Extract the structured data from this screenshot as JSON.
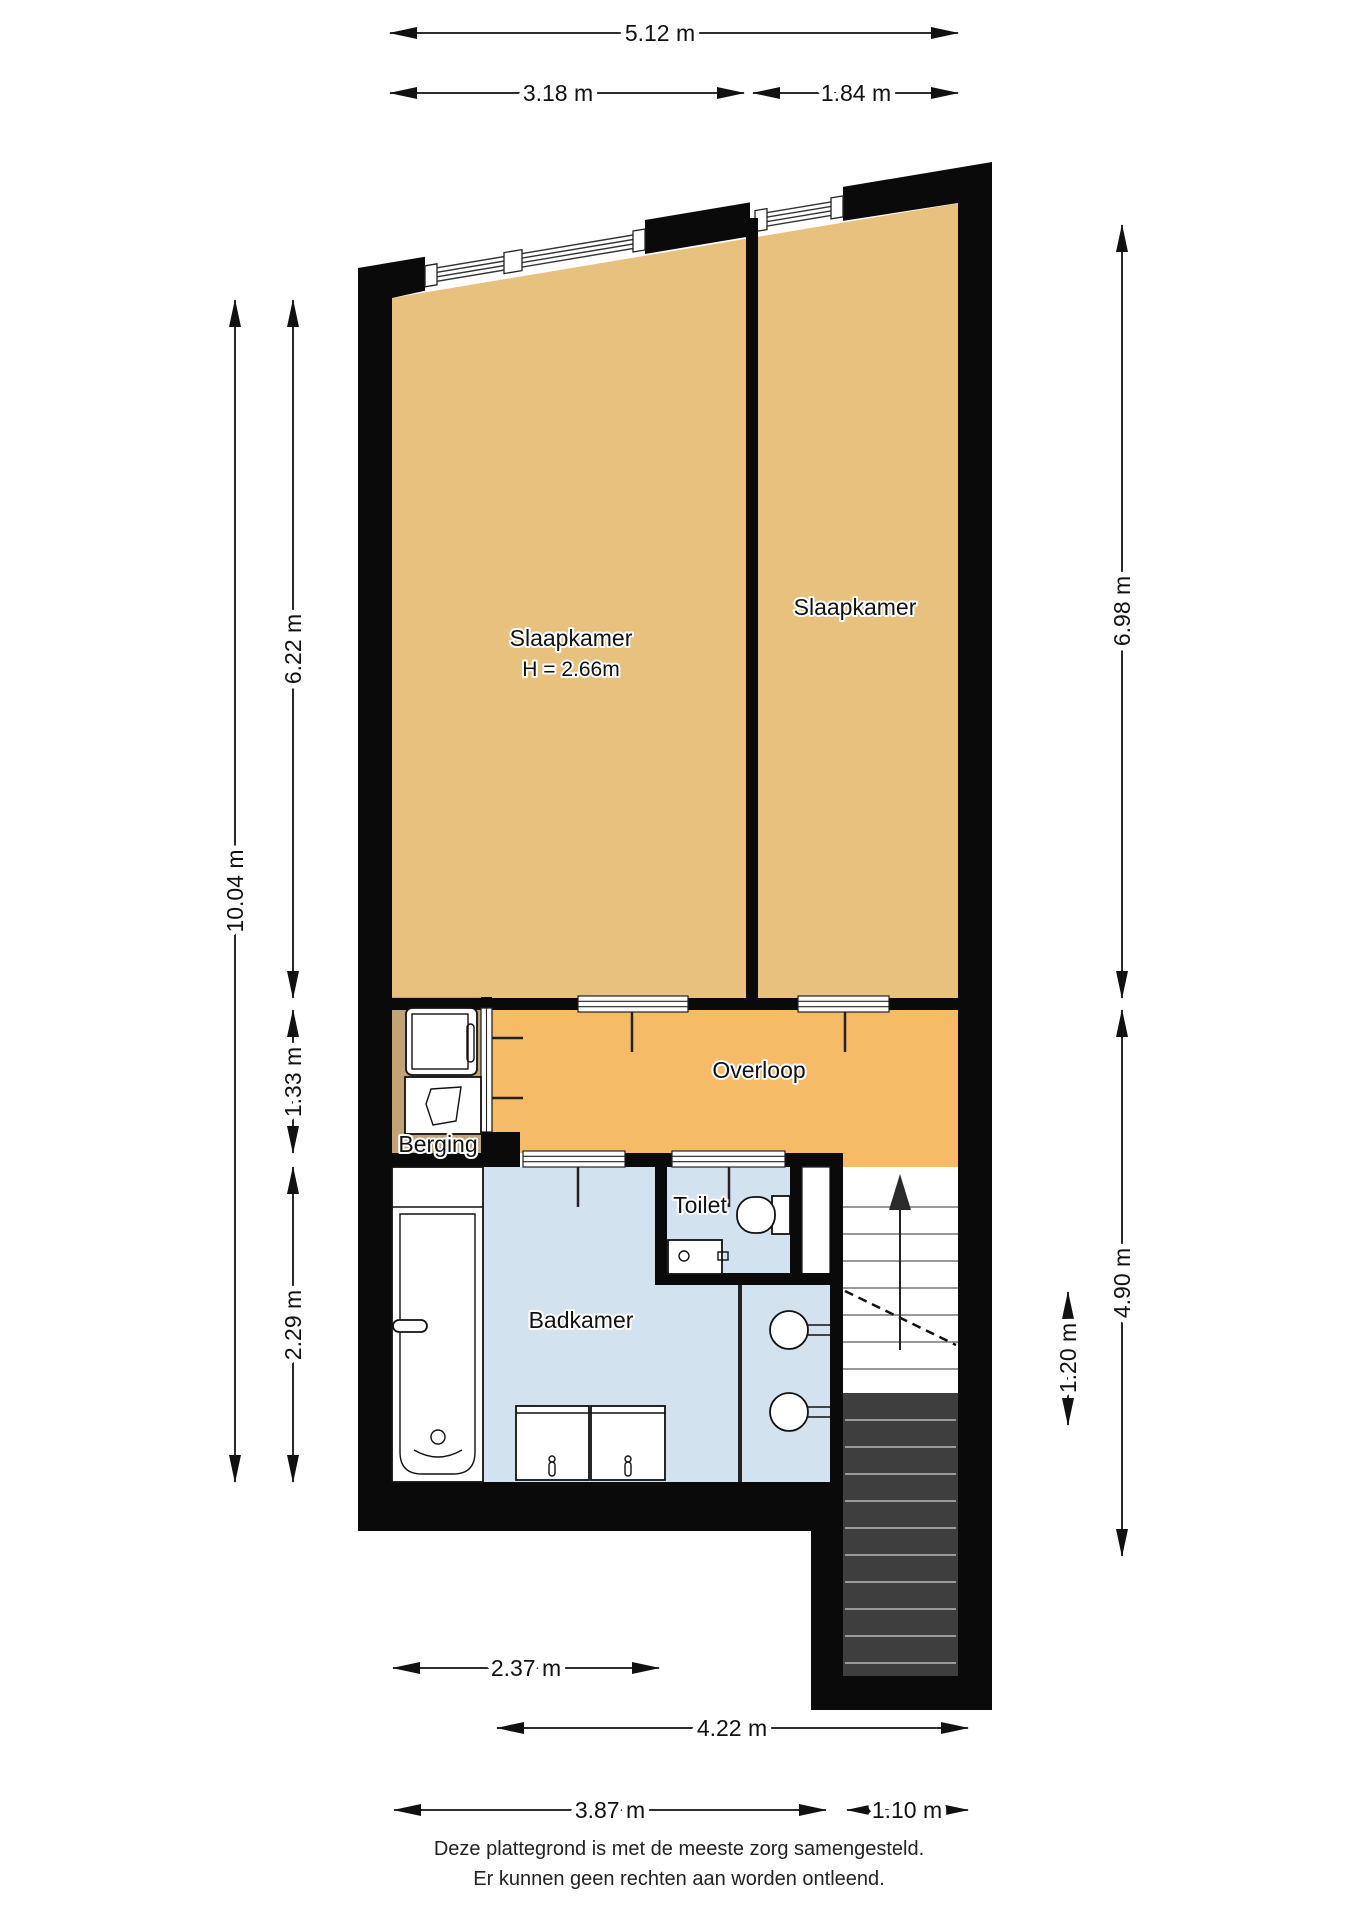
{
  "rooms": {
    "slaapkamer1": {
      "label": "Slaapkamer",
      "height_note": "H = 2.66m"
    },
    "slaapkamer2": {
      "label": "Slaapkamer"
    },
    "overloop": {
      "label": "Overloop"
    },
    "berging": {
      "label": "Berging"
    },
    "badkamer": {
      "label": "Badkamer"
    },
    "toilet": {
      "label": "Toilet"
    }
  },
  "dimensions": {
    "d512": "5.12 m",
    "d318": "3.18 m",
    "d184": "1.84 m",
    "d1004": "10.04 m",
    "d622": "6.22 m",
    "d133": "1.33 m",
    "d229": "2.29 m",
    "d698": "6.98 m",
    "d490": "4.90 m",
    "d120": "1.20 m",
    "d237": "2.37 m",
    "d422": "4.22 m",
    "d387": "3.87 m",
    "d110": "1.10 m"
  },
  "footer": {
    "line1": "Deze plattegrond is met de meeste zorg samengesteld.",
    "line2": "Er kunnen geen rechten aan worden ontleend."
  },
  "colors": {
    "wall": "#0a0a0a",
    "bedroom": "#e9c17f",
    "overloop": "#f6bb66",
    "berging": "#c2a377",
    "bath": "#d3e2ef",
    "stairs_dark": "#3e3e3e"
  }
}
